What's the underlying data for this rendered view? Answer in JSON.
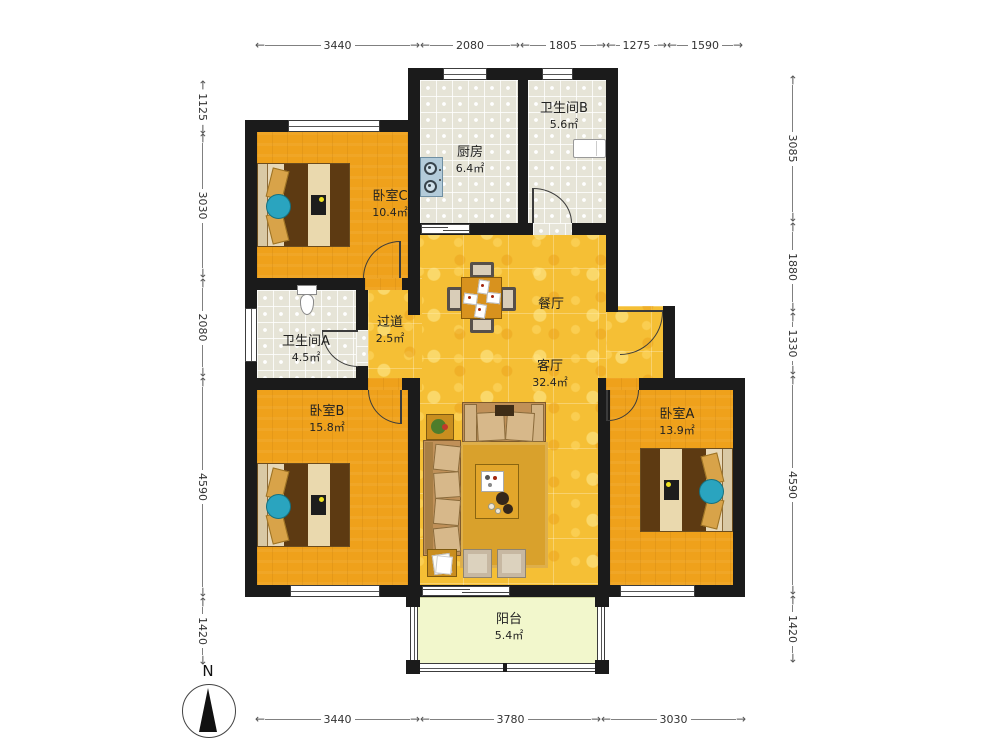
{
  "title": "apartment-floor-plan",
  "north_label": "N",
  "rooms": {
    "bedroomC": {
      "name": "卧室C",
      "area": "10.4㎡"
    },
    "kitchen": {
      "name": "厨房",
      "area": "6.4㎡"
    },
    "bathB": {
      "name": "卫生间B",
      "area": "5.6㎡"
    },
    "bathA": {
      "name": "卫生间A",
      "area": "4.5㎡"
    },
    "corridor": {
      "name": "过道",
      "area": "2.5㎡"
    },
    "dining": {
      "name": "餐厅",
      "area": ""
    },
    "living": {
      "name": "客厅",
      "area": "32.4㎡"
    },
    "bedroomB": {
      "name": "卧室B",
      "area": "15.8㎡"
    },
    "bedroomA": {
      "name": "卧室A",
      "area": "13.9㎡"
    },
    "balcony": {
      "name": "阳台",
      "area": "5.4㎡"
    }
  },
  "dimensions": {
    "top": [
      "3440",
      "2080",
      "1805",
      "1275",
      "1590"
    ],
    "left": [
      "1125",
      "3030",
      "2080",
      "4590",
      "1420"
    ],
    "right": [
      "3085",
      "1880",
      "1330",
      "4590",
      "1420"
    ],
    "bottom": [
      "3440",
      "3780",
      "3030"
    ]
  },
  "colors": {
    "wall": "#1b1b1b",
    "wood_floor": "#EFA11B",
    "golden_floor": "#F5BF35",
    "tile_floor": "#E6E4D7",
    "balcony_floor": "#F2F7CC",
    "accent_teal": "#2AA4BF"
  }
}
